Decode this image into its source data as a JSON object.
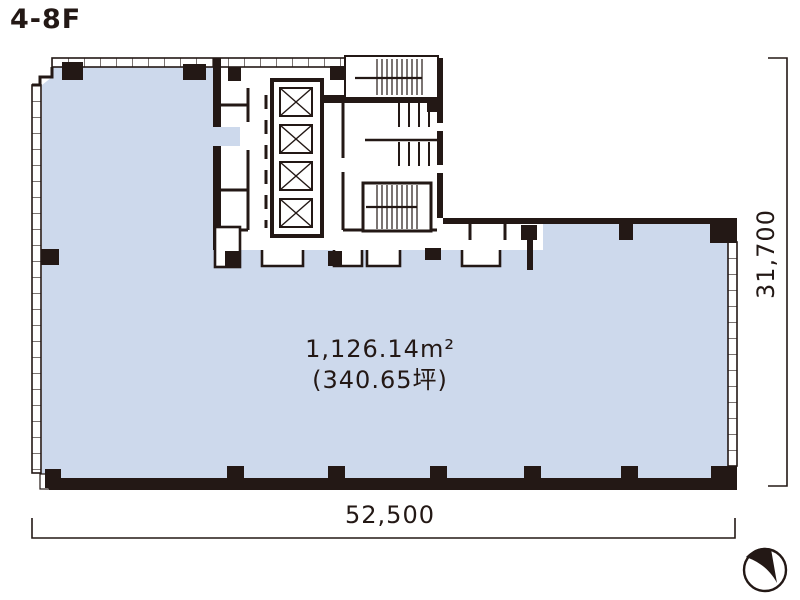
{
  "floor_plan": {
    "title": "4-8F",
    "area_sqm": "1,126.14m²",
    "area_tsubo": "(340.65坪)",
    "width_dimension": "52,500",
    "depth_dimension": "31,700"
  },
  "colors": {
    "tenant_area_fill": "#cdd9ec",
    "wall_line": "#231815",
    "background": "#ffffff"
  },
  "icons": {
    "compass": "north-arrow-compass",
    "elevator": "elevator-x-symbol",
    "stairs": "stair-treads"
  }
}
